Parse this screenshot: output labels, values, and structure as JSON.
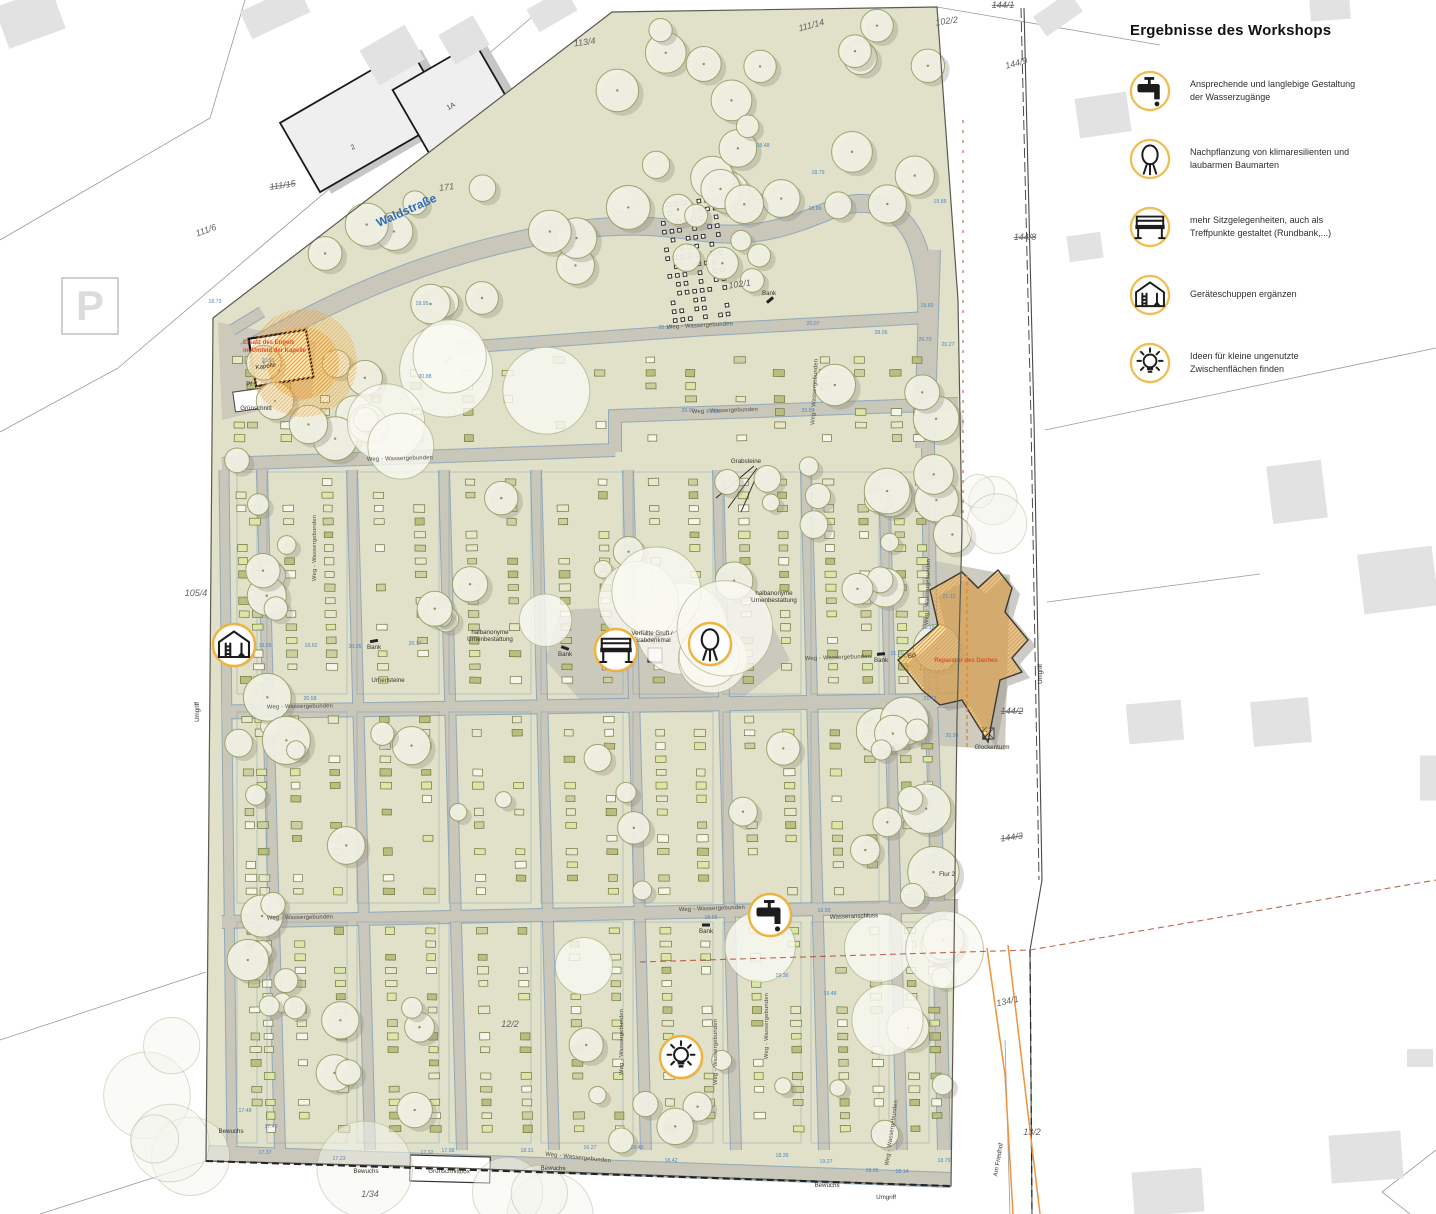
{
  "legend": {
    "title": "Ergebnisse des Workshops",
    "items": [
      {
        "icon": "faucet-icon",
        "text": "Ansprechende und langlebige Gestaltung der Wasserzugänge"
      },
      {
        "icon": "tree-icon",
        "text": "Nachpflanzung von klimaresilienten und laubarmen Baumarten"
      },
      {
        "icon": "bench-icon",
        "text": "mehr Sitzgelegenheiten, auch als Treffpunkte gestaltet (Rundbank,...)"
      },
      {
        "icon": "shed-icon",
        "text": "Geräteschuppen ergänzen"
      },
      {
        "icon": "bulb-icon",
        "text": "Ideen für kleine ungenutzte Zwischenflächen finden"
      }
    ]
  },
  "street": {
    "name": "Waldstraße",
    "x": 408,
    "y": 214,
    "rot": -24
  },
  "annotations": [
    {
      "id": "chapel-highlight",
      "lines": [
        "Ersatz des Engels",
        "im Umfeld der Kapelle"
      ],
      "x": 243,
      "y": 344
    },
    {
      "id": "roof-repair",
      "lines": [
        "Reparatur des Daches"
      ],
      "x": 966,
      "y": 662
    }
  ],
  "markers": [
    {
      "icon": "shed-icon",
      "x": 234,
      "y": 645
    },
    {
      "icon": "bench-icon",
      "x": 616,
      "y": 650
    },
    {
      "icon": "tree-icon",
      "x": 710,
      "y": 644
    },
    {
      "icon": "faucet-icon",
      "x": 770,
      "y": 915
    },
    {
      "icon": "bulb-icon",
      "x": 681,
      "y": 1057
    }
  ],
  "parcel_labels": [
    {
      "text": "113/4",
      "x": 585,
      "y": 45,
      "rot": -8,
      "strike": false
    },
    {
      "text": "111/14",
      "x": 812,
      "y": 28,
      "rot": -15,
      "strike": false
    },
    {
      "text": "102/2",
      "x": 947,
      "y": 24,
      "rot": -8,
      "strike": false
    },
    {
      "text": "144/1",
      "x": 1003,
      "y": 8,
      "rot": 0,
      "strike": true
    },
    {
      "text": "144/9",
      "x": 1017,
      "y": 66,
      "rot": -15,
      "strike": false
    },
    {
      "text": "144/8",
      "x": 1025,
      "y": 240,
      "rot": 0,
      "strike": true
    },
    {
      "text": "111/15",
      "x": 283,
      "y": 188,
      "rot": -8,
      "strike": true
    },
    {
      "text": "171",
      "x": 447,
      "y": 190,
      "rot": -8,
      "strike": false
    },
    {
      "text": "111/6",
      "x": 207,
      "y": 233,
      "rot": -20,
      "strike": false
    },
    {
      "text": "105/4",
      "x": 196,
      "y": 596,
      "rot": 0,
      "strike": false
    },
    {
      "text": "102/1",
      "x": 740,
      "y": 287,
      "rot": -8,
      "strike": false
    },
    {
      "text": "144/2",
      "x": 1012,
      "y": 714,
      "rot": 0,
      "strike": true
    },
    {
      "text": "144/3",
      "x": 1012,
      "y": 840,
      "rot": -8,
      "strike": true
    },
    {
      "text": "134/1",
      "x": 1008,
      "y": 1004,
      "rot": -12,
      "strike": false
    },
    {
      "text": "13/2",
      "x": 1032,
      "y": 1135,
      "rot": 0,
      "strike": false
    },
    {
      "text": "1/34",
      "x": 370,
      "y": 1197,
      "rot": 0,
      "strike": false
    },
    {
      "text": "12/2",
      "x": 510,
      "y": 1027,
      "rot": 0,
      "strike": false
    }
  ],
  "place_labels": [
    {
      "text": "Kapelle",
      "x": 266,
      "y": 368,
      "rot": -8
    },
    {
      "text": "Pf",
      "x": 249,
      "y": 386,
      "rot": 0
    },
    {
      "text": "Grünschnitt",
      "x": 256,
      "y": 410,
      "rot": 0
    },
    {
      "text": "Grabsteine",
      "x": 746,
      "y": 463,
      "rot": 0
    },
    {
      "text": "Bank",
      "x": 769,
      "y": 295,
      "rot": 0
    },
    {
      "text": "Bank",
      "x": 565,
      "y": 656,
      "rot": 0
    },
    {
      "text": "Bank",
      "x": 374,
      "y": 649,
      "rot": 0
    },
    {
      "text": "Bank",
      "x": 706,
      "y": 933,
      "rot": 0
    },
    {
      "text": "Bank",
      "x": 881,
      "y": 662,
      "rot": 0
    },
    {
      "text": "Urnensteine",
      "x": 388,
      "y": 682,
      "rot": 0
    },
    {
      "text": "halbanonyme\nUrnenbestattung",
      "x": 490,
      "y": 634,
      "rot": 0
    },
    {
      "text": "halbanonyme\nUrnenbestattung",
      "x": 774,
      "y": 595,
      "rot": 0
    },
    {
      "text": "Verfüllte Gruft /\nGrabdenkmal",
      "x": 652,
      "y": 635,
      "rot": 0
    },
    {
      "text": "Wasseranschluss",
      "x": 854,
      "y": 918,
      "rot": -2
    },
    {
      "text": "Glockenturm",
      "x": 992,
      "y": 749,
      "rot": 0
    },
    {
      "text": "BP",
      "x": 912,
      "y": 658,
      "rot": 0
    },
    {
      "text": "Bewuchs",
      "x": 231,
      "y": 1133,
      "rot": 0
    },
    {
      "text": "Bewuchs",
      "x": 366,
      "y": 1173,
      "rot": 0
    },
    {
      "text": "Grünschnittbox",
      "x": 449,
      "y": 1173,
      "rot": 1
    },
    {
      "text": "Bewuchs",
      "x": 553,
      "y": 1170,
      "rot": 1
    },
    {
      "text": "Bewuchs",
      "x": 827,
      "y": 1187,
      "rot": 1
    },
    {
      "text": "Umgriff",
      "x": 886,
      "y": 1199,
      "rot": 1
    },
    {
      "text": "Umgriff",
      "x": 199,
      "y": 712,
      "rot": -90
    },
    {
      "text": "Umgriff",
      "x": 1042,
      "y": 674,
      "rot": -90
    },
    {
      "text": "Am Friedhof",
      "x": 1000,
      "y": 1160,
      "rot": -80
    },
    {
      "text": "Flur 2",
      "x": 947,
      "y": 876,
      "rot": 0
    }
  ],
  "building_labels": [
    {
      "text": "2",
      "x": 354,
      "y": 149,
      "rot": -30
    },
    {
      "text": "1A",
      "x": 452,
      "y": 108,
      "rot": -30
    },
    {
      "text": "P",
      "x": 90,
      "y": 320,
      "rot": 0,
      "cls": "psym"
    }
  ],
  "path_label_text": "Weg - Wassergebunden",
  "path_labels": [
    {
      "x": 700,
      "y": 327,
      "rot": -3
    },
    {
      "x": 400,
      "y": 460,
      "rot": -1.5
    },
    {
      "x": 725,
      "y": 412,
      "rot": -2
    },
    {
      "x": 300,
      "y": 708,
      "rot": -1
    },
    {
      "x": 838,
      "y": 659,
      "rot": -2
    },
    {
      "x": 712,
      "y": 910,
      "rot": -2
    },
    {
      "x": 300,
      "y": 919,
      "rot": -1
    },
    {
      "x": 578,
      "y": 1159,
      "rot": 6
    },
    {
      "x": 316,
      "y": 548,
      "rot": -90
    },
    {
      "x": 929,
      "y": 592,
      "rot": -88
    },
    {
      "x": 816,
      "y": 392,
      "rot": -87
    },
    {
      "x": 623,
      "y": 1042,
      "rot": -90
    },
    {
      "x": 717,
      "y": 1052,
      "rot": -90
    },
    {
      "x": 768,
      "y": 1026,
      "rot": -90
    },
    {
      "x": 893,
      "y": 1133,
      "rot": -82
    }
  ],
  "elevations": [
    {
      "v": "18.73",
      "x": 215,
      "y": 303
    },
    {
      "v": "19.95",
      "x": 422,
      "y": 305
    },
    {
      "v": "20.88",
      "x": 425,
      "y": 378
    },
    {
      "v": "18.48",
      "x": 763,
      "y": 147
    },
    {
      "v": "18.79",
      "x": 818,
      "y": 174
    },
    {
      "v": "18.89",
      "x": 815,
      "y": 210
    },
    {
      "v": "19.85",
      "x": 940,
      "y": 203
    },
    {
      "v": "19.60",
      "x": 927,
      "y": 307
    },
    {
      "v": "20.17",
      "x": 665,
      "y": 329
    },
    {
      "v": "20.07",
      "x": 813,
      "y": 325
    },
    {
      "v": "28.06",
      "x": 881,
      "y": 334
    },
    {
      "v": "20.70",
      "x": 925,
      "y": 341
    },
    {
      "v": "20.27",
      "x": 948,
      "y": 346
    },
    {
      "v": "21.12",
      "x": 949,
      "y": 598
    },
    {
      "v": "21.18",
      "x": 928,
      "y": 629
    },
    {
      "v": "21.20",
      "x": 897,
      "y": 655
    },
    {
      "v": "21.42",
      "x": 930,
      "y": 700
    },
    {
      "v": "20.98",
      "x": 952,
      "y": 737
    },
    {
      "v": "19.65",
      "x": 265,
      "y": 647
    },
    {
      "v": "19.62",
      "x": 311,
      "y": 647
    },
    {
      "v": "20.05",
      "x": 355,
      "y": 648
    },
    {
      "v": "20.17",
      "x": 415,
      "y": 645
    },
    {
      "v": "19.55",
      "x": 711,
      "y": 919
    },
    {
      "v": "19.93",
      "x": 824,
      "y": 912
    },
    {
      "v": "19.36",
      "x": 782,
      "y": 977
    },
    {
      "v": "19.48",
      "x": 830,
      "y": 995
    },
    {
      "v": "20.90",
      "x": 688,
      "y": 412
    },
    {
      "v": "20.93",
      "x": 713,
      "y": 413
    },
    {
      "v": "20.89",
      "x": 808,
      "y": 412
    },
    {
      "v": "17.48",
      "x": 245,
      "y": 1112
    },
    {
      "v": "17.40",
      "x": 271,
      "y": 1128
    },
    {
      "v": "17.37",
      "x": 265,
      "y": 1154
    },
    {
      "v": "17.23",
      "x": 339,
      "y": 1160
    },
    {
      "v": "17.92",
      "x": 427,
      "y": 1154
    },
    {
      "v": "17.98",
      "x": 448,
      "y": 1152
    },
    {
      "v": "18.31",
      "x": 527,
      "y": 1152
    },
    {
      "v": "16.27",
      "x": 590,
      "y": 1149
    },
    {
      "v": "18.45",
      "x": 637,
      "y": 1149
    },
    {
      "v": "18.42",
      "x": 671,
      "y": 1162
    },
    {
      "v": "18.39",
      "x": 782,
      "y": 1157
    },
    {
      "v": "19.27",
      "x": 826,
      "y": 1163
    },
    {
      "v": "18.05",
      "x": 872,
      "y": 1172
    },
    {
      "v": "18.14",
      "x": 902,
      "y": 1173
    },
    {
      "v": "18.79",
      "x": 944,
      "y": 1162
    },
    {
      "v": "20.58",
      "x": 310,
      "y": 700
    },
    {
      "v": "20.91",
      "x": 268,
      "y": 362
    }
  ],
  "colors": {
    "site_green": "#e0e1c8",
    "path_gray": "#c9c6ba",
    "path_edge_blue": "#7d9cb5",
    "tree_fill": "#f1f2e5",
    "tree_stroke": "#99a066",
    "accent_orange": "#f0b23e",
    "legend_ring": "#efbf55",
    "annotation_red": "#e04f28",
    "street_blue": "#2f6db5",
    "elevation_blue": "#4f86c0",
    "boundary_red": "#b5493a",
    "utility_orange": "#f0923e"
  }
}
